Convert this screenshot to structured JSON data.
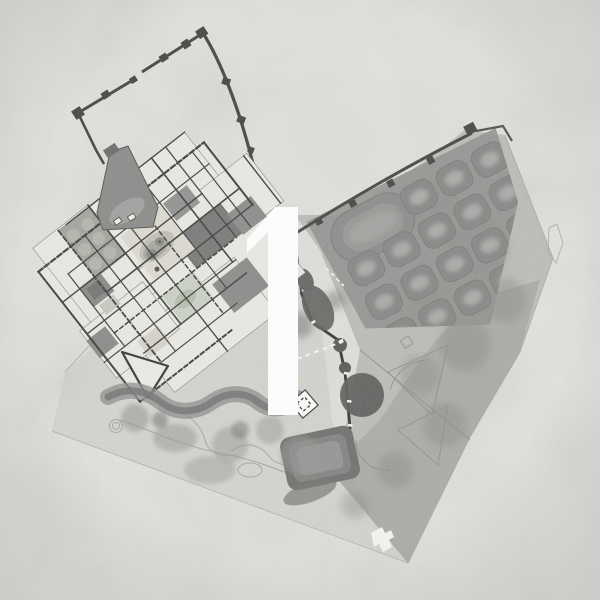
{
  "figure": {
    "kind": "grayscale site plan on textured paper",
    "overlay": {
      "label": "1",
      "color": "#ffffff"
    }
  },
  "palette": {
    "paper": "#e2e1dd",
    "wall_dark": "#4a4a48",
    "plan_base": "#e9e8e3",
    "courtyard_dark": "#7d7d7b",
    "garden_fill": "#939391",
    "canopy": "#8e8e8c",
    "tree_dark": "#5f5f5d",
    "landscape_wash": "#a9a8a4",
    "outline_faint": "#b5b3ae"
  },
  "regions": [
    {
      "id": "fortress-wall-enclosure",
      "kind": "walled enclosure with towers"
    },
    {
      "id": "palace-complex",
      "kind": "detailed building plan with courtyards and ponds"
    },
    {
      "id": "orchard-grid-garden",
      "kind": "garden grid",
      "rows": 4,
      "cols": 5
    },
    {
      "id": "ravine-tree-line",
      "kind": "wall with tree masses"
    },
    {
      "id": "terraced-pool",
      "kind": "nested rectangular terrace"
    },
    {
      "id": "lower-gardens",
      "kind": "landscape wash with paths and canopies"
    },
    {
      "id": "tip-pavilion",
      "kind": "small white building at site tip"
    },
    {
      "id": "site-boundary",
      "kind": "faint boundary outline"
    }
  ]
}
